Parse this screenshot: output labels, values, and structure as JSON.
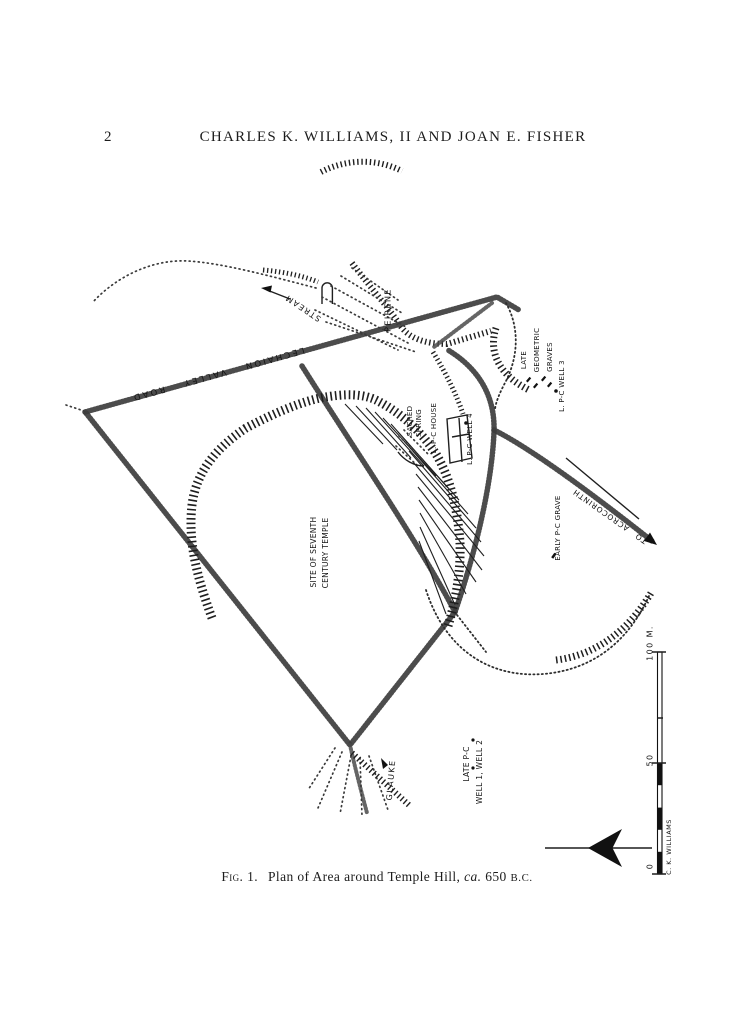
{
  "page": {
    "number": "2",
    "running_head": "CHARLES K. WILLIAMS, II AND JOAN E. FISHER"
  },
  "caption": {
    "fig": "Fig. 1.",
    "body": "Plan of Area around Temple Hill,",
    "ca": "ca.",
    "year": "650",
    "era": "B.C."
  },
  "map": {
    "labels": {
      "stream": "STREAM",
      "peirene": "PEIRENE",
      "lechaion_road": "LECHAION VALLEY ROAD",
      "late": "LATE",
      "geometric": "GEOMETRIC",
      "graves": "GRAVES",
      "well3": "L. P-C WELL 3",
      "sacred": "SACRED",
      "spring": "SPRING",
      "house": "L. P-C HOUSE",
      "well4": "L. P-C WELL 4",
      "to_acrocorinth": "TO ACROCORINTH",
      "early_grave": "EARLY P-C GRAVE",
      "site_line1": "SITE OF SEVENTH",
      "site_line2": "CENTURY TEMPLE",
      "late_pc": "LATE P-C",
      "wells12": "WELL 1, WELL 2",
      "glauke": "GLAUKE"
    },
    "scale": {
      "top": "100 M.",
      "mid": "50",
      "bottom": "0",
      "credit": "C. K. WILLIAMS"
    },
    "ink": "#1f1f1f",
    "paper": "#ffffff"
  }
}
